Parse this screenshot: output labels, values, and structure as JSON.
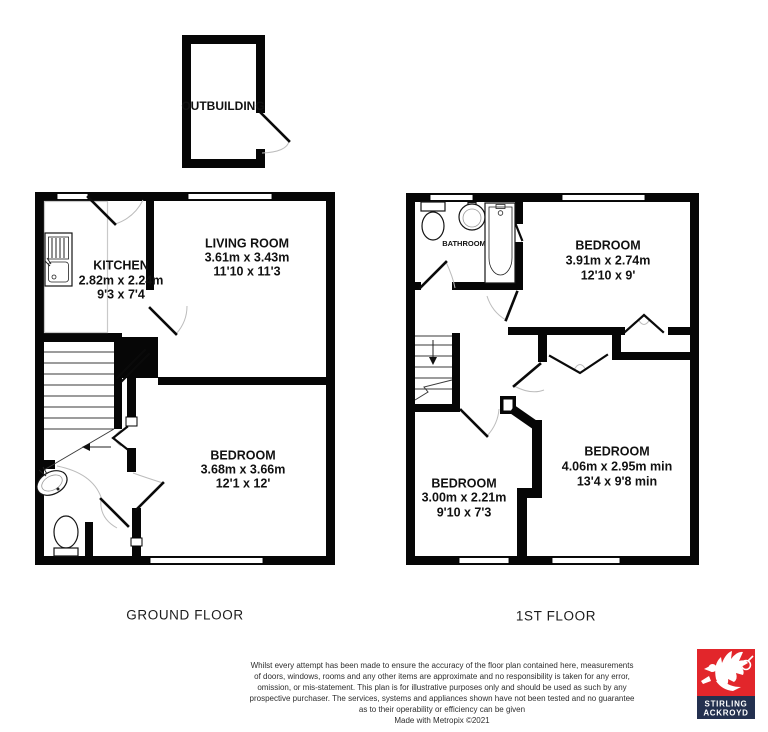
{
  "outbuilding": {
    "label": "OUTBUILDING"
  },
  "ground_floor": {
    "caption": "GROUND FLOOR",
    "kitchen": {
      "name": "KITCHEN",
      "metric": "2.82m x 2.24m",
      "imperial": "9'3 x 7'4"
    },
    "living_room": {
      "name": "LIVING ROOM",
      "metric": "3.61m x 3.43m",
      "imperial": "11'10 x 11'3"
    },
    "bedroom": {
      "name": "BEDROOM",
      "metric": "3.68m x 3.66m",
      "imperial": "12'1 x 12'"
    }
  },
  "first_floor": {
    "caption": "1ST FLOOR",
    "bathroom": {
      "name": "BATHROOM"
    },
    "bedroom_top": {
      "name": "BEDROOM",
      "metric": "3.91m x 2.74m",
      "imperial": "12'10 x 9'"
    },
    "bedroom_bottom_right": {
      "name": "BEDROOM",
      "metric": "4.06m x 2.95m min",
      "imperial": "13'4 x 9'8 min"
    },
    "bedroom_bottom_left": {
      "name": "BEDROOM",
      "metric": "3.00m x 2.21m",
      "imperial": "9'10 x 7'3"
    }
  },
  "disclaimer": {
    "lines": [
      "Whilst every attempt has been made to ensure the accuracy of the floor plan contained here, measurements",
      "of doors, windows, rooms and any other items are approximate and no responsibility is taken for any error,",
      "omission, or mis-statement. This plan is for illustrative purposes only and should be used as such by any",
      "prospective purchaser. The services, systems and appliances shown have not been tested and no guarantee",
      "as to their operability or efficiency can be given"
    ],
    "credit": "Made with Metropix ©2021"
  },
  "logo": {
    "line1": "STIRLING",
    "line2": "ACKROYD",
    "red": "#e2262b",
    "navy": "#23304f"
  },
  "colors": {
    "wall": "#000000",
    "door_arc": "#bcbcbc"
  }
}
